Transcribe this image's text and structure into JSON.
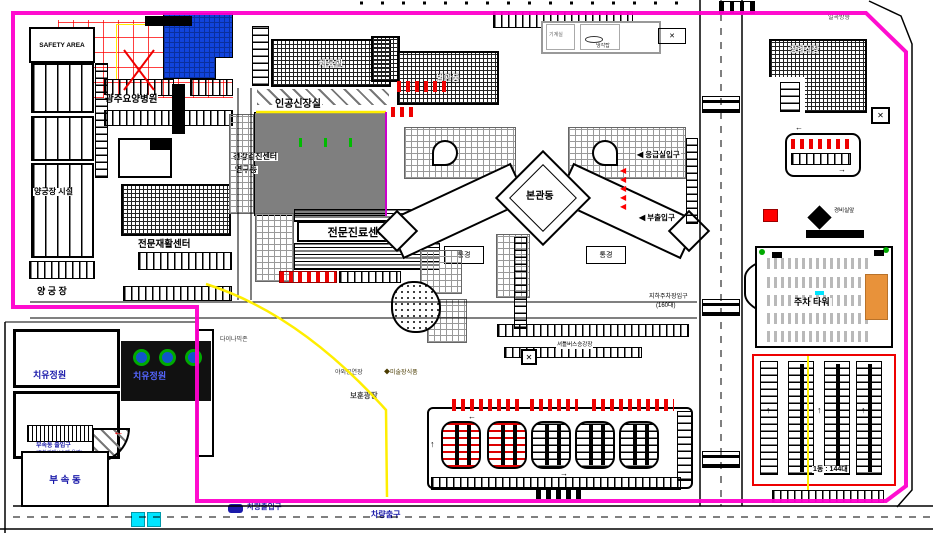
{
  "plan": {
    "type": "hospital campus site plan (CAD drawing)",
    "colors": {
      "boundary_magenta": "#ff00cc",
      "blue_building": "#1144dd",
      "orange_block": "#e8923a",
      "highlight_yellow": "#ffff00",
      "car_red": "#ff0000",
      "bus_cyan": "#00e5ff",
      "entrance_text_navy": "#1a1aaa",
      "tree_green": "#00aa00"
    }
  },
  "icons": {
    "arrow_left": "◀",
    "arrow_right": "▶",
    "arrow_up": "↑",
    "arrow_left_thin": "←",
    "arrow_right_thin": "→",
    "x_mark": "✕",
    "diamond": "◆"
  },
  "labels": {
    "safety_area": "SAFETY AREA",
    "nursing_hospital": "광주요양병원",
    "archery_facility": "양궁장 시설",
    "archery_field": "양 궁 장",
    "rehab_center": "전문재활센터",
    "gym": "체육관",
    "annex_hall": "별관동",
    "machine_room": "기계실",
    "cooling_tower": "냉각탑",
    "kidney_room": "인공신장실",
    "checkup_line1": "건강검진센터",
    "checkup_line2": "연구동",
    "clinic_center": "전문진료센터",
    "main_building": "본관동",
    "court_left": "통경",
    "court_right": "통경",
    "er_entrance": "응급실입구",
    "sub_entrance": "부출입구",
    "funeral_hall": "장례식장",
    "direction_top": "일곡방향",
    "guard_room": "경비실앞",
    "parking_tower": "주차 타워",
    "lot_count": "1동 : 144대",
    "underground_line1": "지하주차장입구",
    "underground_line2": "(160대)",
    "shuttle_stop": "셔틀버스승강장",
    "outdoor_stage": "야외공연장",
    "art_sculpture": "미술장식품",
    "plaza": "보훈광장",
    "dynamic_zone": "다이나믹존",
    "healing_garden_left": "치유정원",
    "healing_garden_right": "치유정원",
    "annex_entrance_line1": "부속동 출입구",
    "annex_entrance_line2": "(주차관제시스템 운영)",
    "annex_small": "부 속 동",
    "vehicle_gate": "차량출입구",
    "vehicle_exit": "차량출구"
  }
}
